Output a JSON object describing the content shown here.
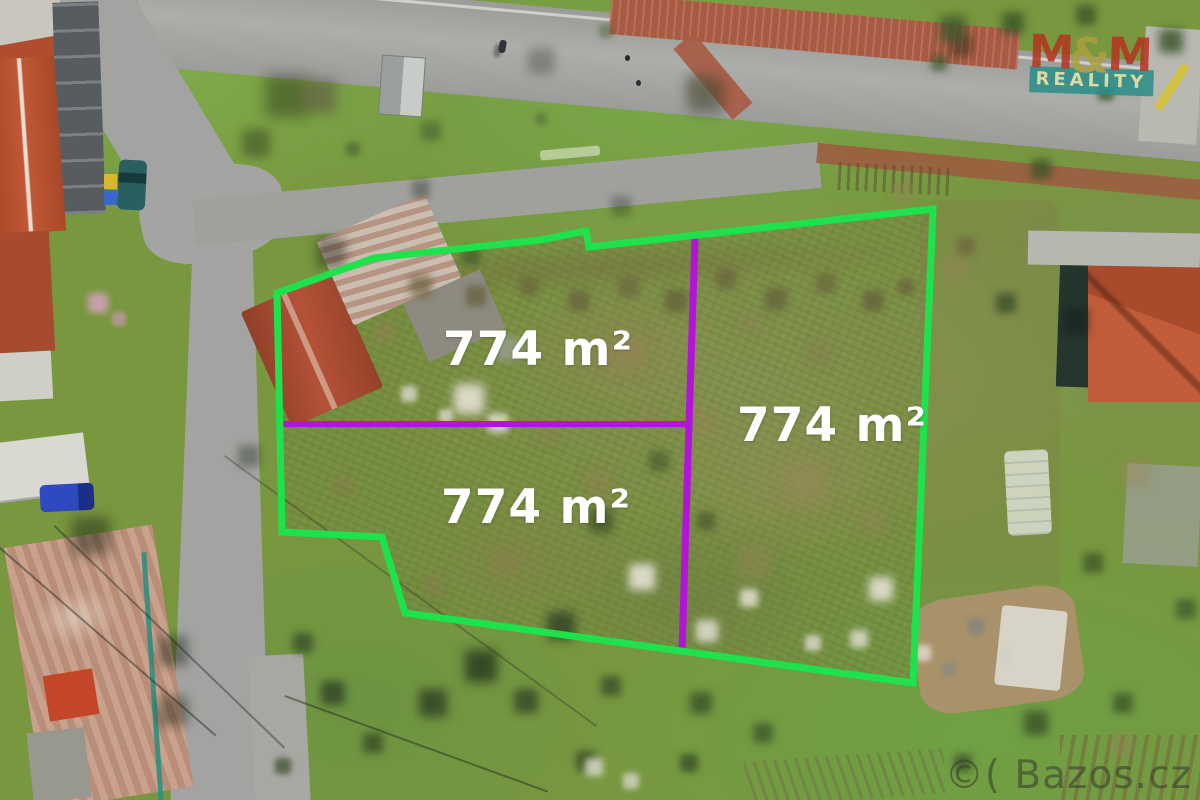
{
  "overlays": {
    "plot_area_labels": [
      {
        "text": "774 m²"
      },
      {
        "text": "774 m²"
      },
      {
        "text": "774 m²"
      }
    ]
  },
  "branding": {
    "agency_logo": {
      "m_left": "M",
      "ampersand": "&",
      "m_right": "M",
      "subtitle": "REALITY"
    },
    "photo_watermark": "©( Bazos.cz"
  },
  "colors": {
    "plot_boundary_green": "#1de24c",
    "plot_divider_purple": "#b315d8",
    "area_label_white": "#ffffff",
    "logo_red": "#b5341f",
    "logo_ampersand_olive": "#ac9f3e",
    "logo_banner_teal": "#2a8f88",
    "logo_banner_text": "#e9e2a2",
    "logo_slash_yellow": "#d7c531",
    "watermark_gray": "#343826"
  }
}
